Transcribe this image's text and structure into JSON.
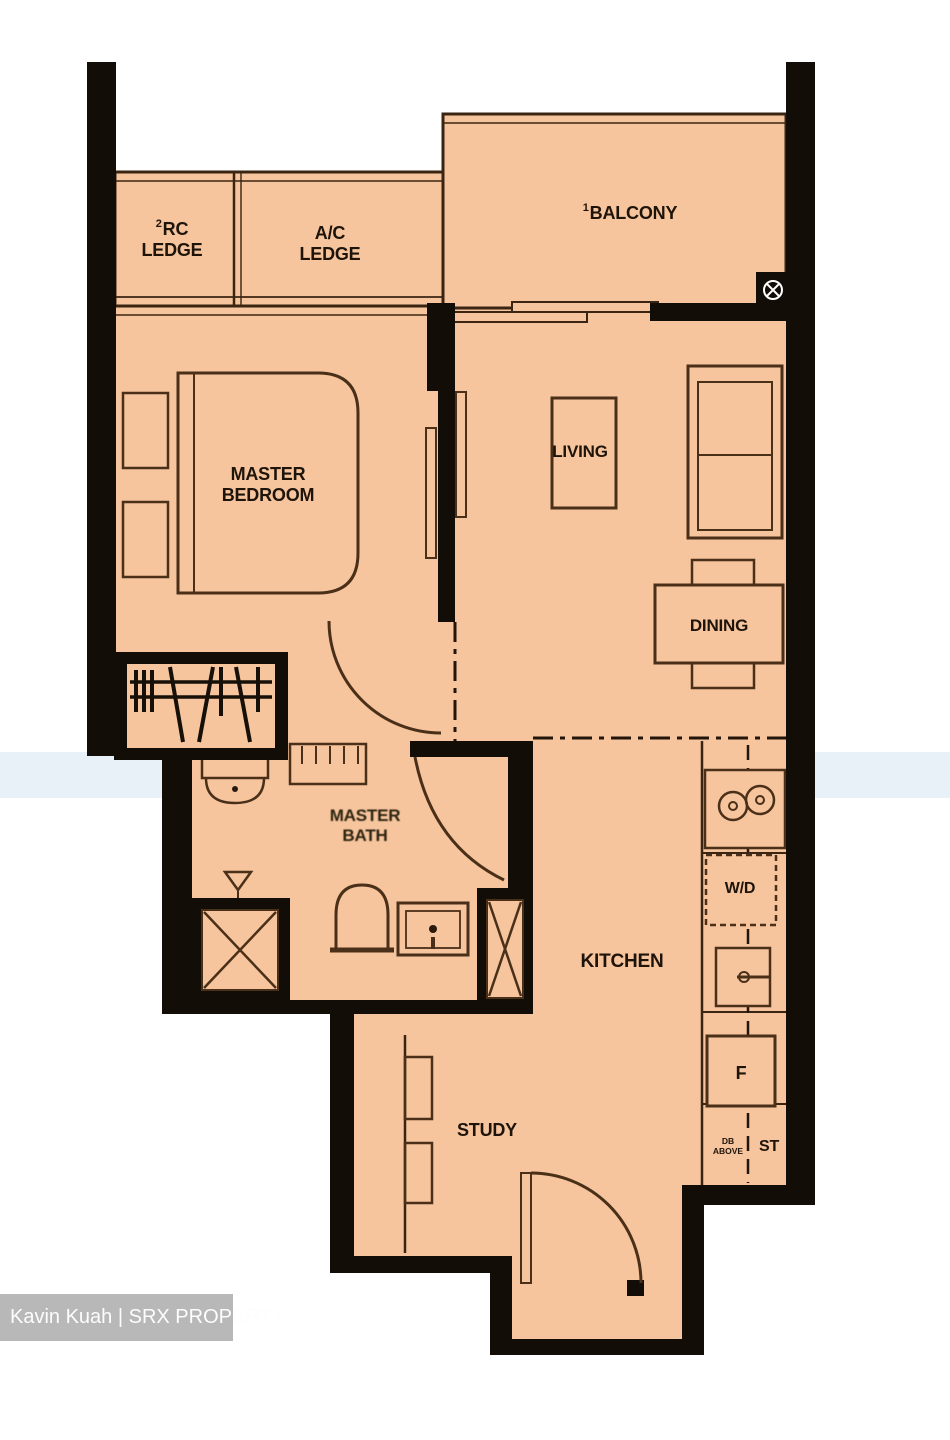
{
  "document": {
    "type": "floor-plan"
  },
  "rooms": {
    "rc_ledge": {
      "sup": "2",
      "name": "RC LEDGE"
    },
    "ac_ledge": {
      "name": "A/C LEDGE"
    },
    "balcony": {
      "sup": "1",
      "name": "BALCONY"
    },
    "master_bedroom": {
      "name": "MASTER BEDROOM"
    },
    "living": {
      "name": "LIVING"
    },
    "dining": {
      "name": "DINING"
    },
    "master_bath": {
      "name": "MASTER BATH"
    },
    "kitchen": {
      "name": "KITCHEN"
    },
    "study": {
      "name": "STUDY"
    }
  },
  "fixtures": {
    "washer_dryer": "W/D",
    "fridge": "F",
    "store": "ST",
    "db_above": "DB ABOVE"
  },
  "icons": {
    "balcony_floor_trap": "circle-x-icon",
    "shower": "crossed-square",
    "duct_shaft": "crossed-square",
    "wardrobe": "hanger-rail"
  },
  "colors": {
    "floor": "#f6c49d",
    "wall": "#130d07",
    "furniture_line": "#4a3018",
    "watermark_bg": "#b2b2b2",
    "watermark_text": "#fdfdfd"
  },
  "watermark": {
    "text": "Kavin Kuah | SRX PROPERTY"
  }
}
